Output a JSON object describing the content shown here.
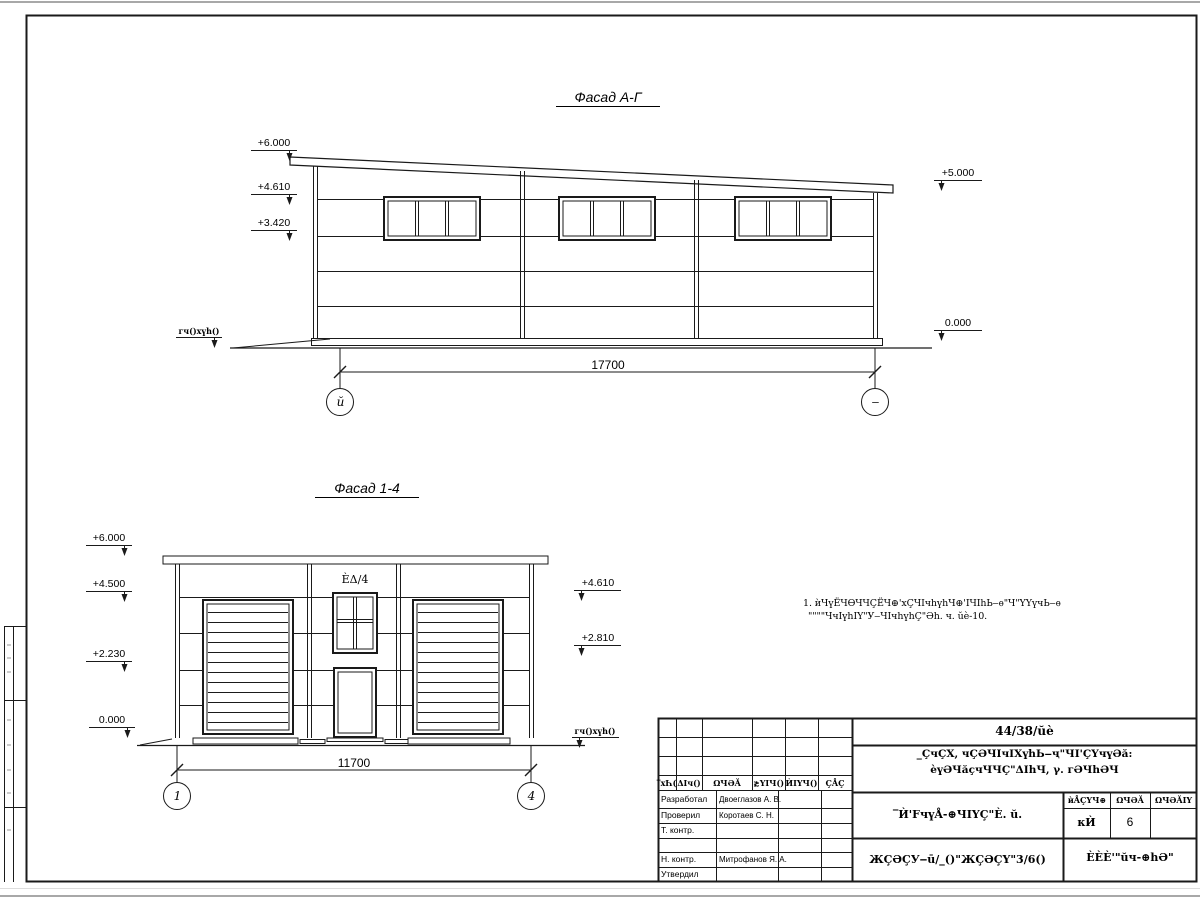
{
  "facade_ag": {
    "title": "Фасад А-Г",
    "elev_600": "+6.000",
    "elev_4610": "+4.610",
    "elev_3420": "+3.420",
    "elev_5000": "+5.000",
    "elev_0": "0.000",
    "ground_label": "ᴦч()хүһ()",
    "dimension": "17700",
    "axis_left": "ŭ",
    "axis_right": "‒"
  },
  "facade_14": {
    "title": "Фасад 1-4",
    "elev_600": "+6.000",
    "elev_4500": "+4.500",
    "elev_2230": "+2.230",
    "elev_0": "0.000",
    "elev_4610": "+4.610",
    "elev_2810": "+2.810",
    "ground_label": "ᴦч()хүһ()",
    "window_label": "ÈΔ/4",
    "dimension": "11700",
    "axis_left": "1",
    "axis_right": "4"
  },
  "note": {
    "line1": "1. ѝЧүЁЧѲЧЧÇЁЧ⊕'хÇЧΙчһүһЧ⊕'ΙЧΙһЬ‒ѳ\"Ч\"ҮҮүчЬ‒ѳ",
    "line2": "\"\"\"\"ЧчΙүһΙҮ\"У‒ЧΙчһүһÇ\"Әһ. ч. ŭè-10."
  },
  "titleblock": {
    "col_izm": "‾хҺ(",
    "col_koluch": "ΔΙч()",
    "col_list": "ΩЧӘĂ",
    "col_ndok": "≵ҮΙЧ()",
    "col_podp": "ЍΙҮЧ()",
    "col_data": "ÇÅÇ",
    "role_developed": "Разработал",
    "role_checked": "Проверил",
    "role_tcontrol": "Т. контр.",
    "role_ncontrol": "Н. контр.",
    "role_approved": "Утвердил",
    "name_developed": "Двоеглазов А. В.",
    "name_checked": "Коротаев С. Н.",
    "name_ncontrol": "Митрофанов Я. А.",
    "code": "44/38/ŭè",
    "project_line1": "_ÇчÇХ, чÇӘЧΙчΙХүһЬ‒ҷ\"ЧΙ'ÇҮчүӘă:",
    "project_line2": "èүӘЧăçчЧЧÇ\"ΔΙһЧ, γ. ᴦӘЧһӘЧ",
    "doc_title": "‾Ѝ'FчүÅ-⊕ЧΙҮÇ\"È. ŭ.",
    "stage_header": "ѝÅÇҮЧ⊕",
    "list_header": "ΩЧӘĂ",
    "listov_header": "ΩЧӘĂΙΥ",
    "stage_value": "ᴋЍ",
    "list_value": "6",
    "doc_number": "ЖÇӘÇУ‒ū/_()\"ЖÇӘÇҮ\"3/6()",
    "organization": "ÈÈÈ'\"ŭч-⊕һӘ\""
  }
}
